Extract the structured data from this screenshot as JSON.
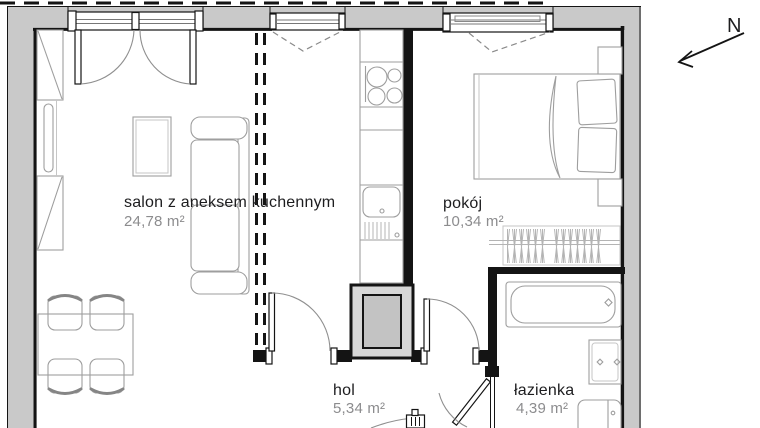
{
  "plan": {
    "type": "apartment-floor-plan",
    "north_label": "N",
    "rooms": {
      "salon": {
        "name": "salon z aneksem kuchennym",
        "area": "24,78 m²"
      },
      "pokoj": {
        "name": "pokój",
        "area": "10,34 m²"
      },
      "hol": {
        "name": "hol",
        "area": "5,34 m²"
      },
      "lazienka": {
        "name": "łazienka",
        "area": "4,39 m²"
      }
    },
    "colors": {
      "wall_fill": "#c9c9c9",
      "wall_line": "#141414",
      "furniture_line": "#9e9e9e",
      "label_text": "#1d1d1f",
      "area_text": "#8c8c8e",
      "shaft_fill": "#d7d7d7",
      "shaft_inner": "#c3c3c3"
    }
  }
}
